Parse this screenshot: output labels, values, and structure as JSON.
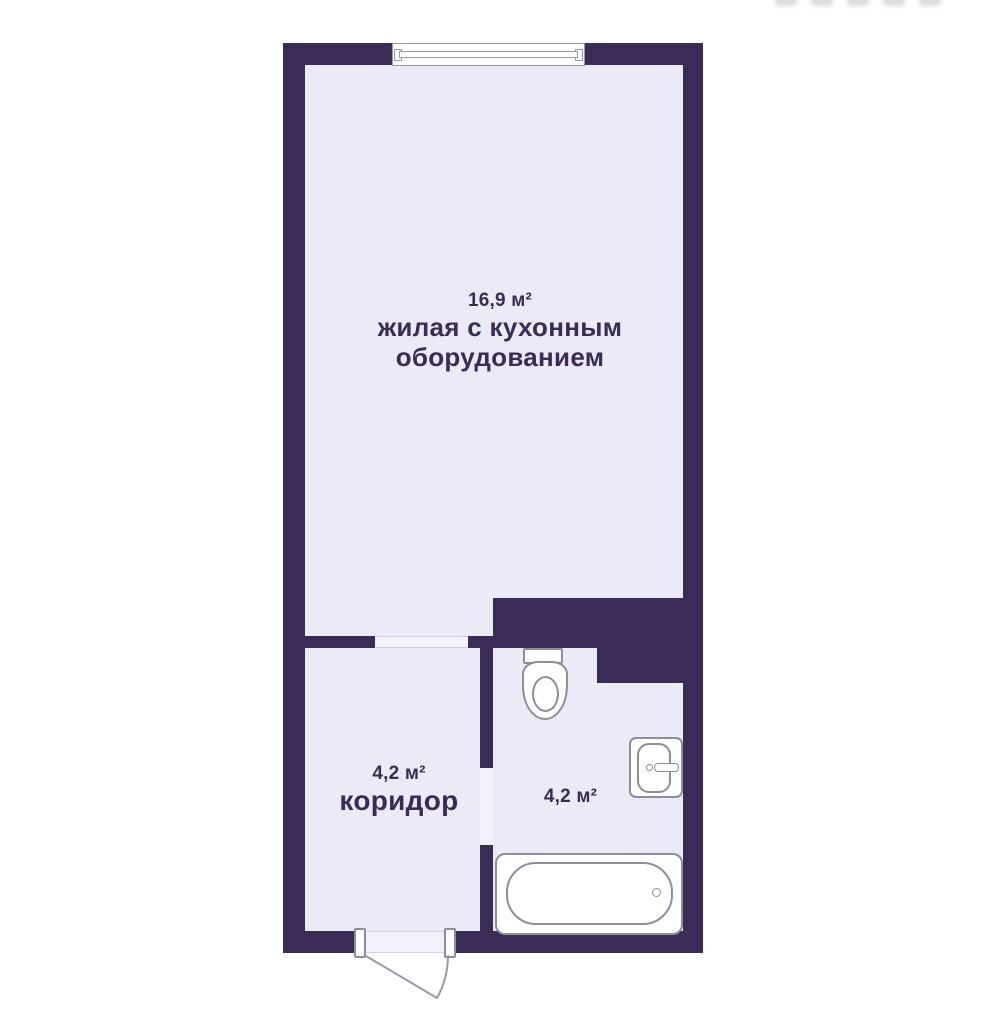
{
  "plan": {
    "title": "studio apartment floor plan",
    "rooms": [
      {
        "id": "living-kitchen",
        "area_label": "16,9 м²",
        "name_line1": "жилая с кухонным",
        "name_line2": "оборудованием"
      },
      {
        "id": "corridor",
        "area_label": "4,2 м²",
        "name": "коридор"
      },
      {
        "id": "bathroom",
        "area_label": "4,2 м²"
      }
    ],
    "fixtures": [
      "window",
      "toilet",
      "sink",
      "bathtub",
      "entrance-door"
    ],
    "colors": {
      "wall": "#3a2c56",
      "floor": "#edeaf7",
      "background": "#ffffff",
      "fixture_outline": "#8f8c9e",
      "text": "#3a2c56",
      "threshold": "#f4f2fb"
    }
  }
}
